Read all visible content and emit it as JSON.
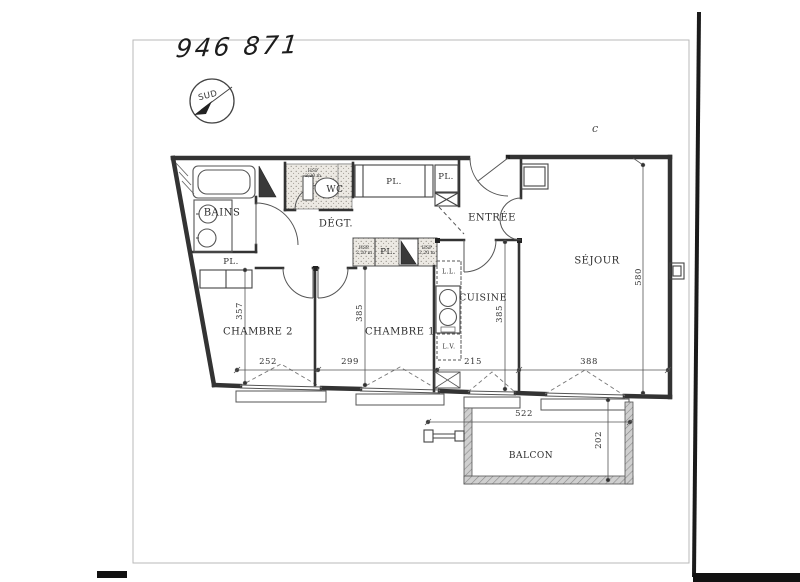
{
  "page": {
    "plan_number": "946 871",
    "compass_label": "SUD",
    "stray_mark": "c"
  },
  "rooms": [
    {
      "id": "bains",
      "label": "BAINS"
    },
    {
      "id": "wc",
      "label": "WC"
    },
    {
      "id": "degagement",
      "label": "DÉGT."
    },
    {
      "id": "entree",
      "label": "ENTRÉE"
    },
    {
      "id": "sejour",
      "label": "SÉJOUR"
    },
    {
      "id": "cuisine",
      "label": "CUISINE"
    },
    {
      "id": "chambre1",
      "label": "CHAMBRE 1"
    },
    {
      "id": "chambre2",
      "label": "CHAMBRE 2"
    },
    {
      "id": "balcon",
      "label": "BALCON"
    }
  ],
  "closets": [
    {
      "id": "pl-haut-grand",
      "label": "PL."
    },
    {
      "id": "pl-haut-petit",
      "label": "PL."
    },
    {
      "id": "pl-chambre2",
      "label": "PL."
    },
    {
      "id": "pl-degagement",
      "label": "PL."
    }
  ],
  "ceiling_height_notes": [
    {
      "line1": "HSP",
      "line2": "2,20 m"
    },
    {
      "line1": "HSP",
      "line2": "2,20 m"
    },
    {
      "line1": "HSP",
      "line2": "2,20 m"
    }
  ],
  "appliances": [
    {
      "id": "lave-linge",
      "label": "L.L."
    },
    {
      "id": "lave-vaisselle",
      "label": "L.V."
    }
  ],
  "dimensions_cm": [
    {
      "label": "252",
      "room": "chambre2",
      "axis": "width"
    },
    {
      "label": "299",
      "room": "chambre1",
      "axis": "width"
    },
    {
      "label": "215",
      "room": "cuisine",
      "axis": "width"
    },
    {
      "label": "388",
      "room": "sejour",
      "axis": "width"
    },
    {
      "label": "357",
      "room": "chambre2",
      "axis": "depth"
    },
    {
      "label": "385",
      "room": "chambre1",
      "axis": "depth"
    },
    {
      "label": "385",
      "room": "cuisine",
      "axis": "depth"
    },
    {
      "label": "580",
      "room": "sejour",
      "axis": "depth"
    },
    {
      "label": "522",
      "room": "balcon",
      "axis": "width"
    },
    {
      "label": "202",
      "room": "balcon",
      "axis": "depth"
    }
  ],
  "colors": {
    "wall": "#333333",
    "paper": "#ffffff",
    "dim_line": "#555555",
    "scan_artifact": "#111111",
    "stipple_bg": "#ece9e3"
  }
}
